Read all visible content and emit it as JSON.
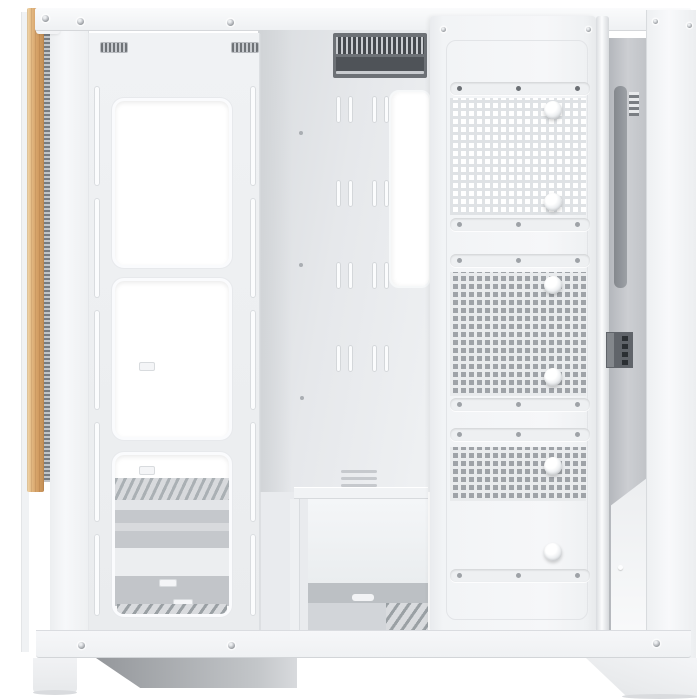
{
  "image_type": "product-photo",
  "subject": "white mid-tower PC case, side panel removed, interior view",
  "visible_text": [],
  "colors": {
    "bg": "#ffffff",
    "case-white": "#f4f5f7",
    "panel-light": "#eef0f2",
    "edge": "#d8dadd",
    "tray": "#e2e4e7",
    "chamber": "#c0c3c7",
    "vent-dark": "#4f5358",
    "slat-frame": "#6d7176",
    "hole-dark": "#9fa3a8",
    "web-light": "#dfe2e5",
    "web-gray": "#e9ebed",
    "wood": "#d9a76e",
    "wood-light": "#f1d9b0",
    "wood-dark": "#c38f55",
    "shadow-dark": "#94979b",
    "foot-shadow": "#d9dbde"
  },
  "parts": {
    "front_accent": "vertical wood strip with mesh filter edge",
    "fan_bracket": "white bracket, two slotted rails, three rounded fan cutouts",
    "motherboard_tray": "cable-tie slot rows, CPU cooler cutout, top exhaust vent",
    "psu_shroud": "white PSU front panel, gray base strip, bottom intake grille",
    "cable_cover": "three perforated fan plates with oval slot bars and hub holes",
    "rear_chamber": "recessed rear channel with connector block and vents",
    "feet": "white case feet with floor shadows"
  },
  "structure": {
    "fan_cutouts": 3,
    "rail_slot_segments_per_rail": 5,
    "cable_tie_rows": 4,
    "tie_columns": 2,
    "perforated_plates": 3,
    "hub_holes": 6,
    "slot_bars": 6,
    "top_rail_screws": 6,
    "bottom_rail_screws": 3
  }
}
